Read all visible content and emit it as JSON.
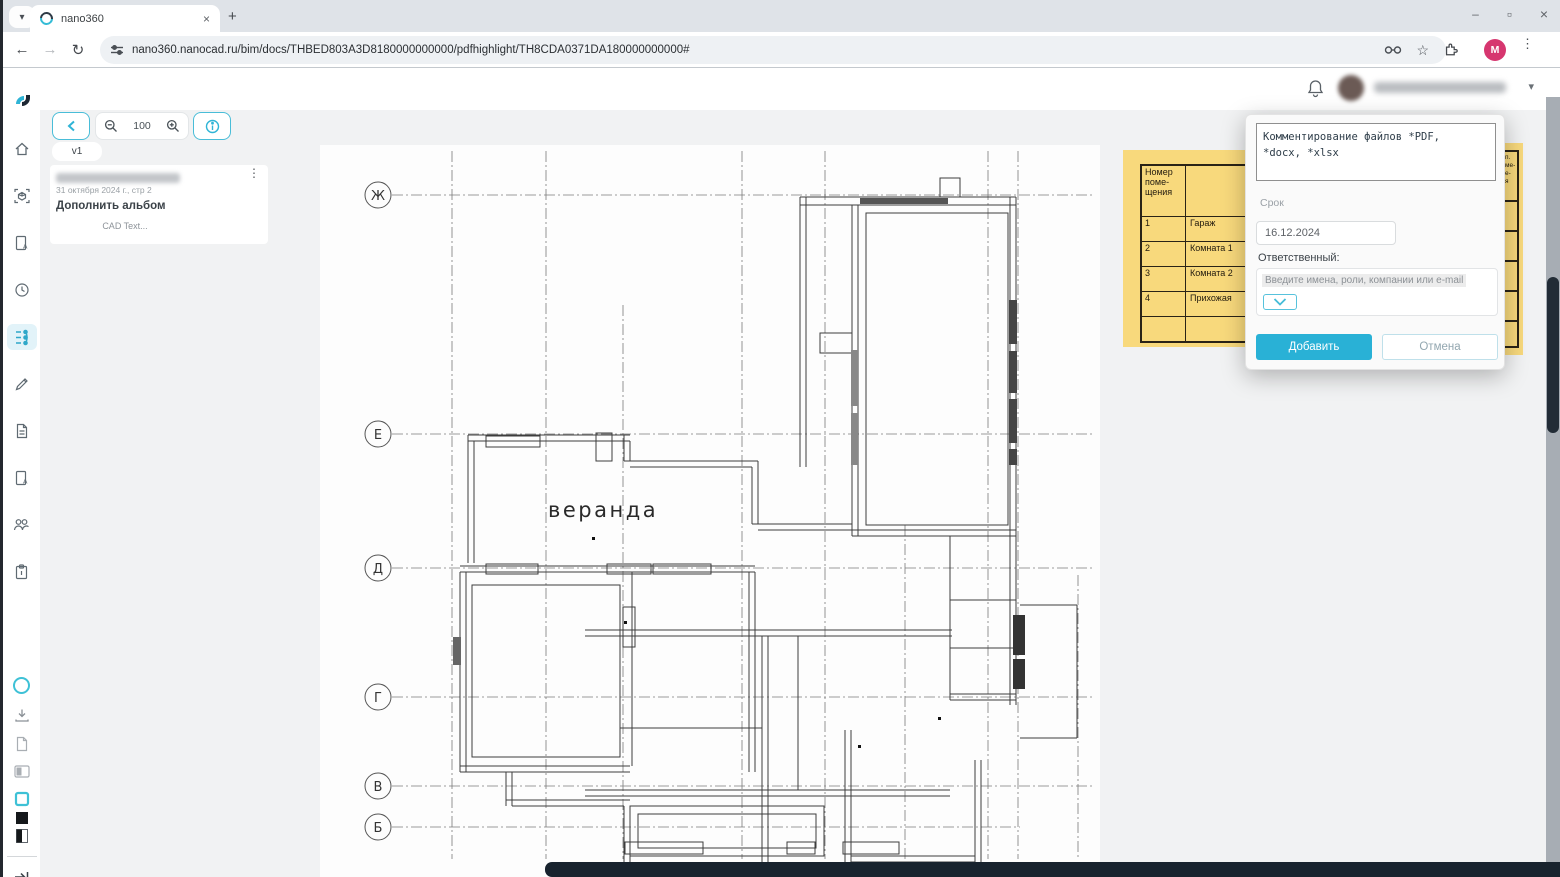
{
  "browser": {
    "tab_title": "nano360",
    "new_tab_label": "+",
    "url": "nano360.nanocad.ru/bim/docs/THBED803A3D8180000000000/pdfhighlight/TH8CDA0371DA180000000000#",
    "profile_initial": "M",
    "close_tab_glyph": "×",
    "minimize_glyph": "–",
    "restore_glyph": "▫",
    "close_glyph": "×",
    "back_glyph": "←",
    "forward_glyph": "→",
    "reload_glyph": "↻",
    "kebab_glyph": "⋮"
  },
  "panel": {
    "zoom_level": "100",
    "version_tab": "v1",
    "card": {
      "date_line": "31 октября 2024 г., стр 2",
      "title": "Дополнить альбом",
      "subtitle": "CAD Text...",
      "kebab_glyph": "⋮"
    }
  },
  "drawing": {
    "room_label": "веранда",
    "axes": [
      "Ж",
      "Е",
      "Д",
      "Г",
      "В",
      "Б"
    ]
  },
  "room_table": {
    "header_lines": [
      "Номер",
      "поме-",
      "щения"
    ],
    "rows": [
      {
        "num": "1",
        "name": "Гараж"
      },
      {
        "num": "2",
        "name": "Комната 1"
      },
      {
        "num": "3",
        "name": "Комната 2"
      },
      {
        "num": "4",
        "name": "Прихожая"
      },
      {
        "num": "",
        "name": ""
      }
    ],
    "right_fragments": [
      "п.",
      "ме-",
      "е-",
      "я"
    ]
  },
  "dialog": {
    "comment_text": "Комментирование файлов *PDF,\n*docx, *xlsx",
    "due_label": "Срок",
    "due_value": "16.12.2024",
    "assignee_label": "Ответственный:",
    "assignee_placeholder": "Введите имена, роли, компании или e-mail",
    "add_button": "Добавить",
    "cancel_button": "Отмена"
  },
  "colors": {
    "accent": "#2fb4d6",
    "table_yellow": "#f8d97c",
    "dark_bar": "#18232e",
    "profile_pink": "#d6366f"
  }
}
